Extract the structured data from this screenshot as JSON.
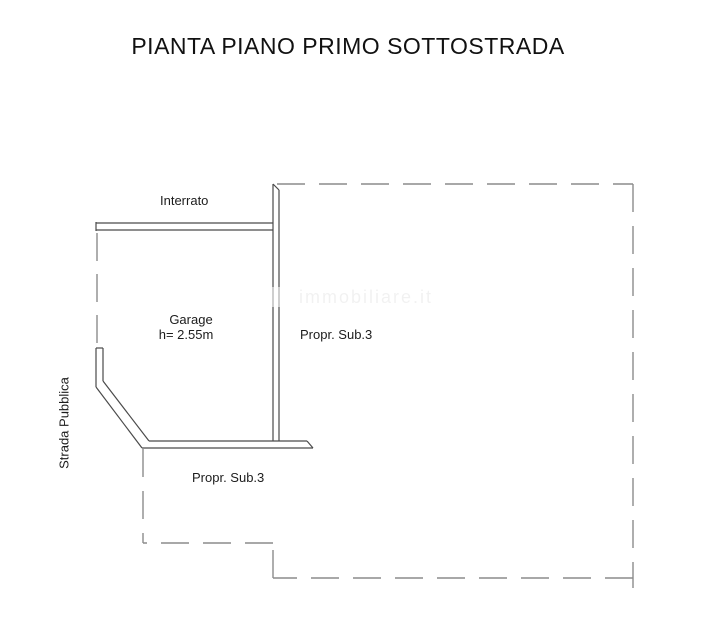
{
  "title": "PIANTA PIANO PRIMO SOTTOSTRADA",
  "plan": {
    "labels": {
      "interrato": "Interrato",
      "garage_name": "Garage",
      "garage_height": "h= 2.55m",
      "propr_sub3_right": "Propr. Sub.3",
      "propr_sub3_bottom": "Propr. Sub.3",
      "strada_pubblica": "Strada Pubblica",
      "watermark": "immobiliare.it"
    },
    "colors": {
      "wall_line": "#4a4a4a",
      "dashed_line": "#8c8c8c",
      "text": "#1c1c1c",
      "background": "#ffffff"
    }
  }
}
